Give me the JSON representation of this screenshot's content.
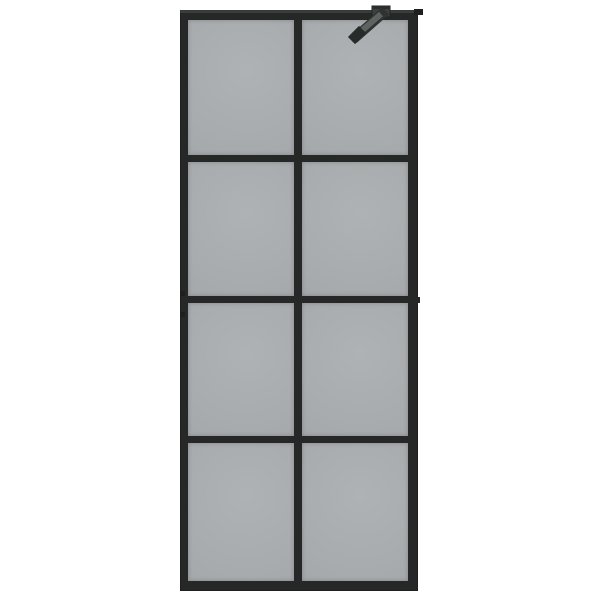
{
  "scene": {
    "object": "walk-in shower wall screen with smoked grey glass and black grid frame",
    "panes": {
      "rows": 4,
      "columns": 2
    },
    "hardware": [
      "top support arm bracket",
      "right side connector nub",
      "wall profile notches"
    ]
  },
  "colors": {
    "background": "#ffffff",
    "frame": "#262827",
    "frame-dark": "#1e2020",
    "frame-highlight": "#4a4f4e",
    "glass": "#a8abad",
    "glass-light": "#afb2b4",
    "glass-dark": "#a2a6a8",
    "arm": "#5d6361",
    "arm-dark": "#2e3231",
    "arm-tip": "#272b2a"
  }
}
